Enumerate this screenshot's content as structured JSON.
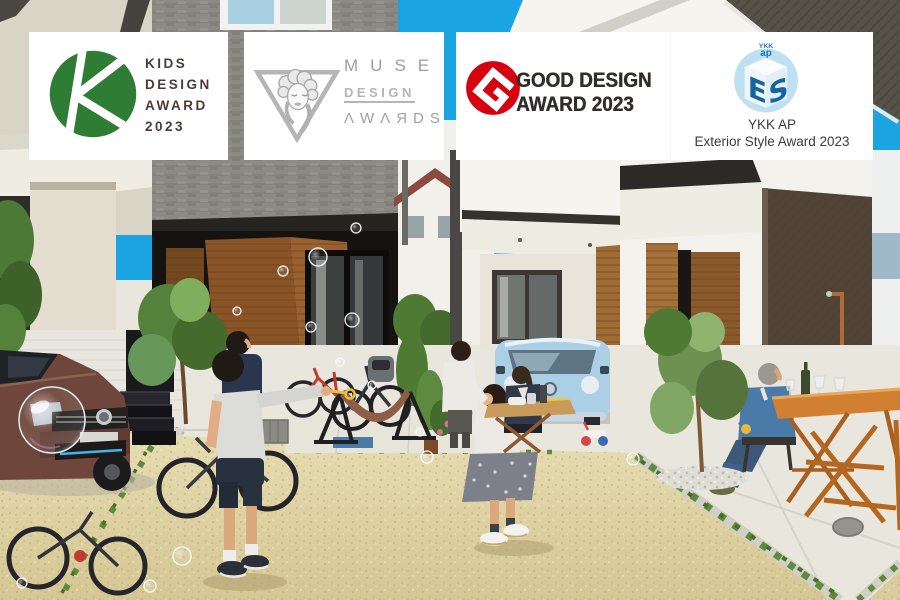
{
  "palette": {
    "sky": "#1ba4e2",
    "concrete": "#e9e6de",
    "ground_gravel": "#d9cda0",
    "stone_wall": "#8b8a85",
    "wood_panel": "#9c6a35",
    "vw_brown": "#6f463b",
    "kei_car_blue": "#abcfe5",
    "hammock_brown": "#8f5d45",
    "table_orange": "#d08030",
    "kids_green": "#2f7c34",
    "kids_text": "#4c3a38",
    "muse_gray": "#a2a2a2",
    "good_design_red": "#d7000f",
    "good_design_text": "#332d2a",
    "ykk_dark_blue": "#15649e",
    "ykk_light_blue": "#bfe0f1"
  },
  "badges": {
    "kids": {
      "line1": "KIDS",
      "line2": "DESIGN",
      "line3": "AWARD",
      "line4": "2023"
    },
    "muse": {
      "title": "MUSE",
      "mid": "DESIGN",
      "bottom": "ΛWΛЯDS"
    },
    "good": {
      "line1": "GOOD DESIGN",
      "line2": "AWARD 2023"
    },
    "ykk": {
      "logo_top": "YKK",
      "logo_sub": "ap",
      "cube_left": "E",
      "cube_right": "S",
      "line1": "YKK AP",
      "line2": "Exterior Style Award 2023"
    }
  }
}
